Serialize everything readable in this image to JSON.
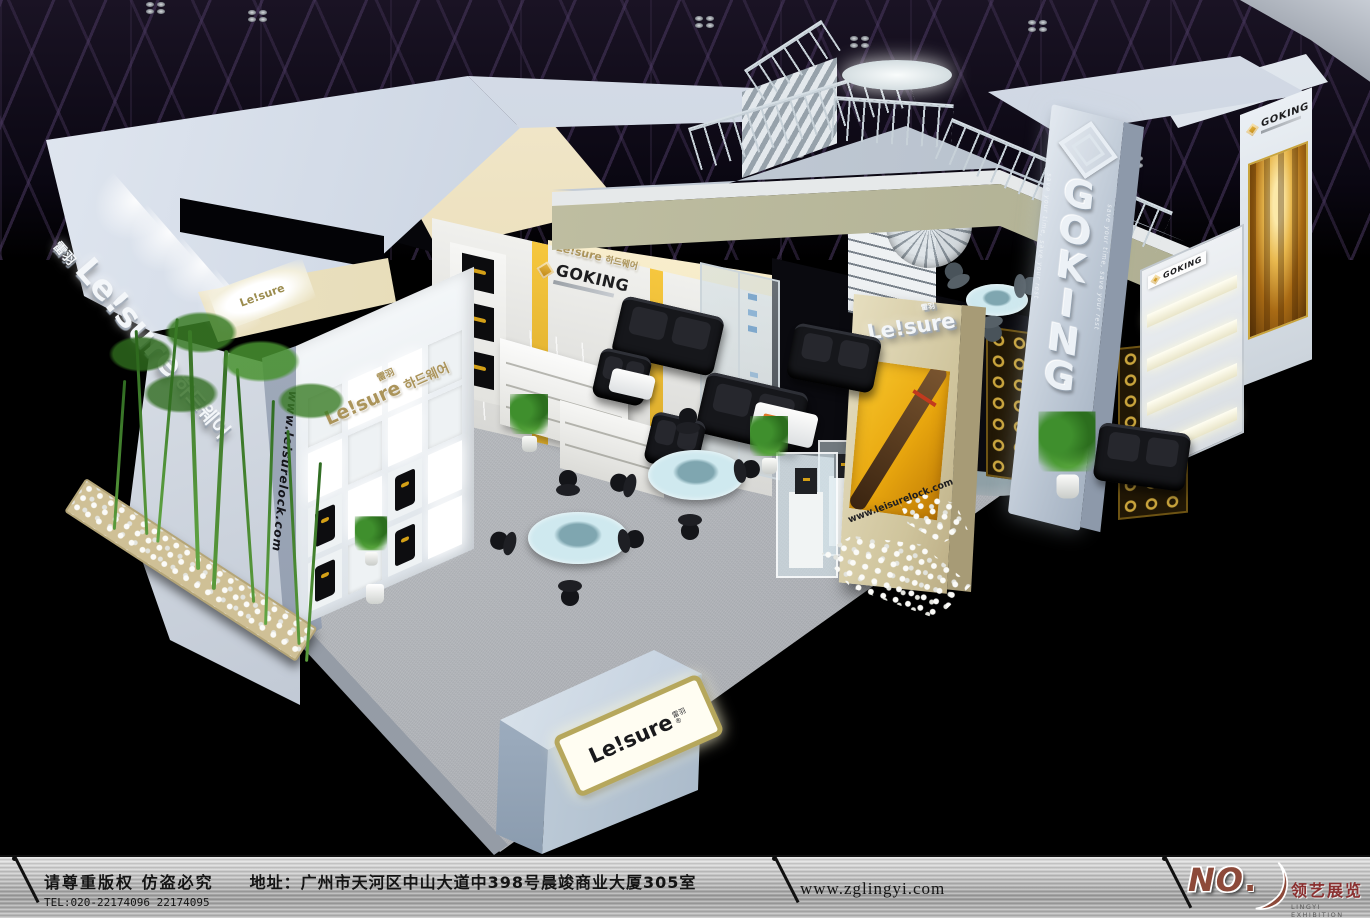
{
  "booth": {
    "leisure": {
      "brand": "Le!sure",
      "brand_cn": "雷羽",
      "brand_kr": "하드웨어",
      "reg": "®",
      "website": "www.leisurelock.com"
    },
    "goking": {
      "brand": "GOKING",
      "vertical_letters": [
        "G",
        "O",
        "K",
        "I",
        "N",
        "G"
      ],
      "tagline": "save your time, save your rest"
    }
  },
  "footer": {
    "copyright": "请尊重版权 仿盗必究",
    "tel": "TEL:020-22174096 22174095",
    "address": "地址：广州市天河区中山大道中398号晨竣商业大厦305室",
    "website": "www.zglingyi.com",
    "logo": {
      "no": "NO",
      "dot": ".",
      "company_cn": "领艺展览",
      "company_en": "LINGYI EXHIBITION"
    }
  },
  "colors": {
    "hall_background": "#000000",
    "booth_panel": "#c5cfdd",
    "carpet": "#b7babf",
    "khaki_beam": "#b9bda4",
    "beige_column": "#d8cfae",
    "accent_gold": "#d4a017",
    "leisure_gold": "#ab945a",
    "footer_metal": "#c0c0c0",
    "logo_copper": "#8d4a3a"
  }
}
